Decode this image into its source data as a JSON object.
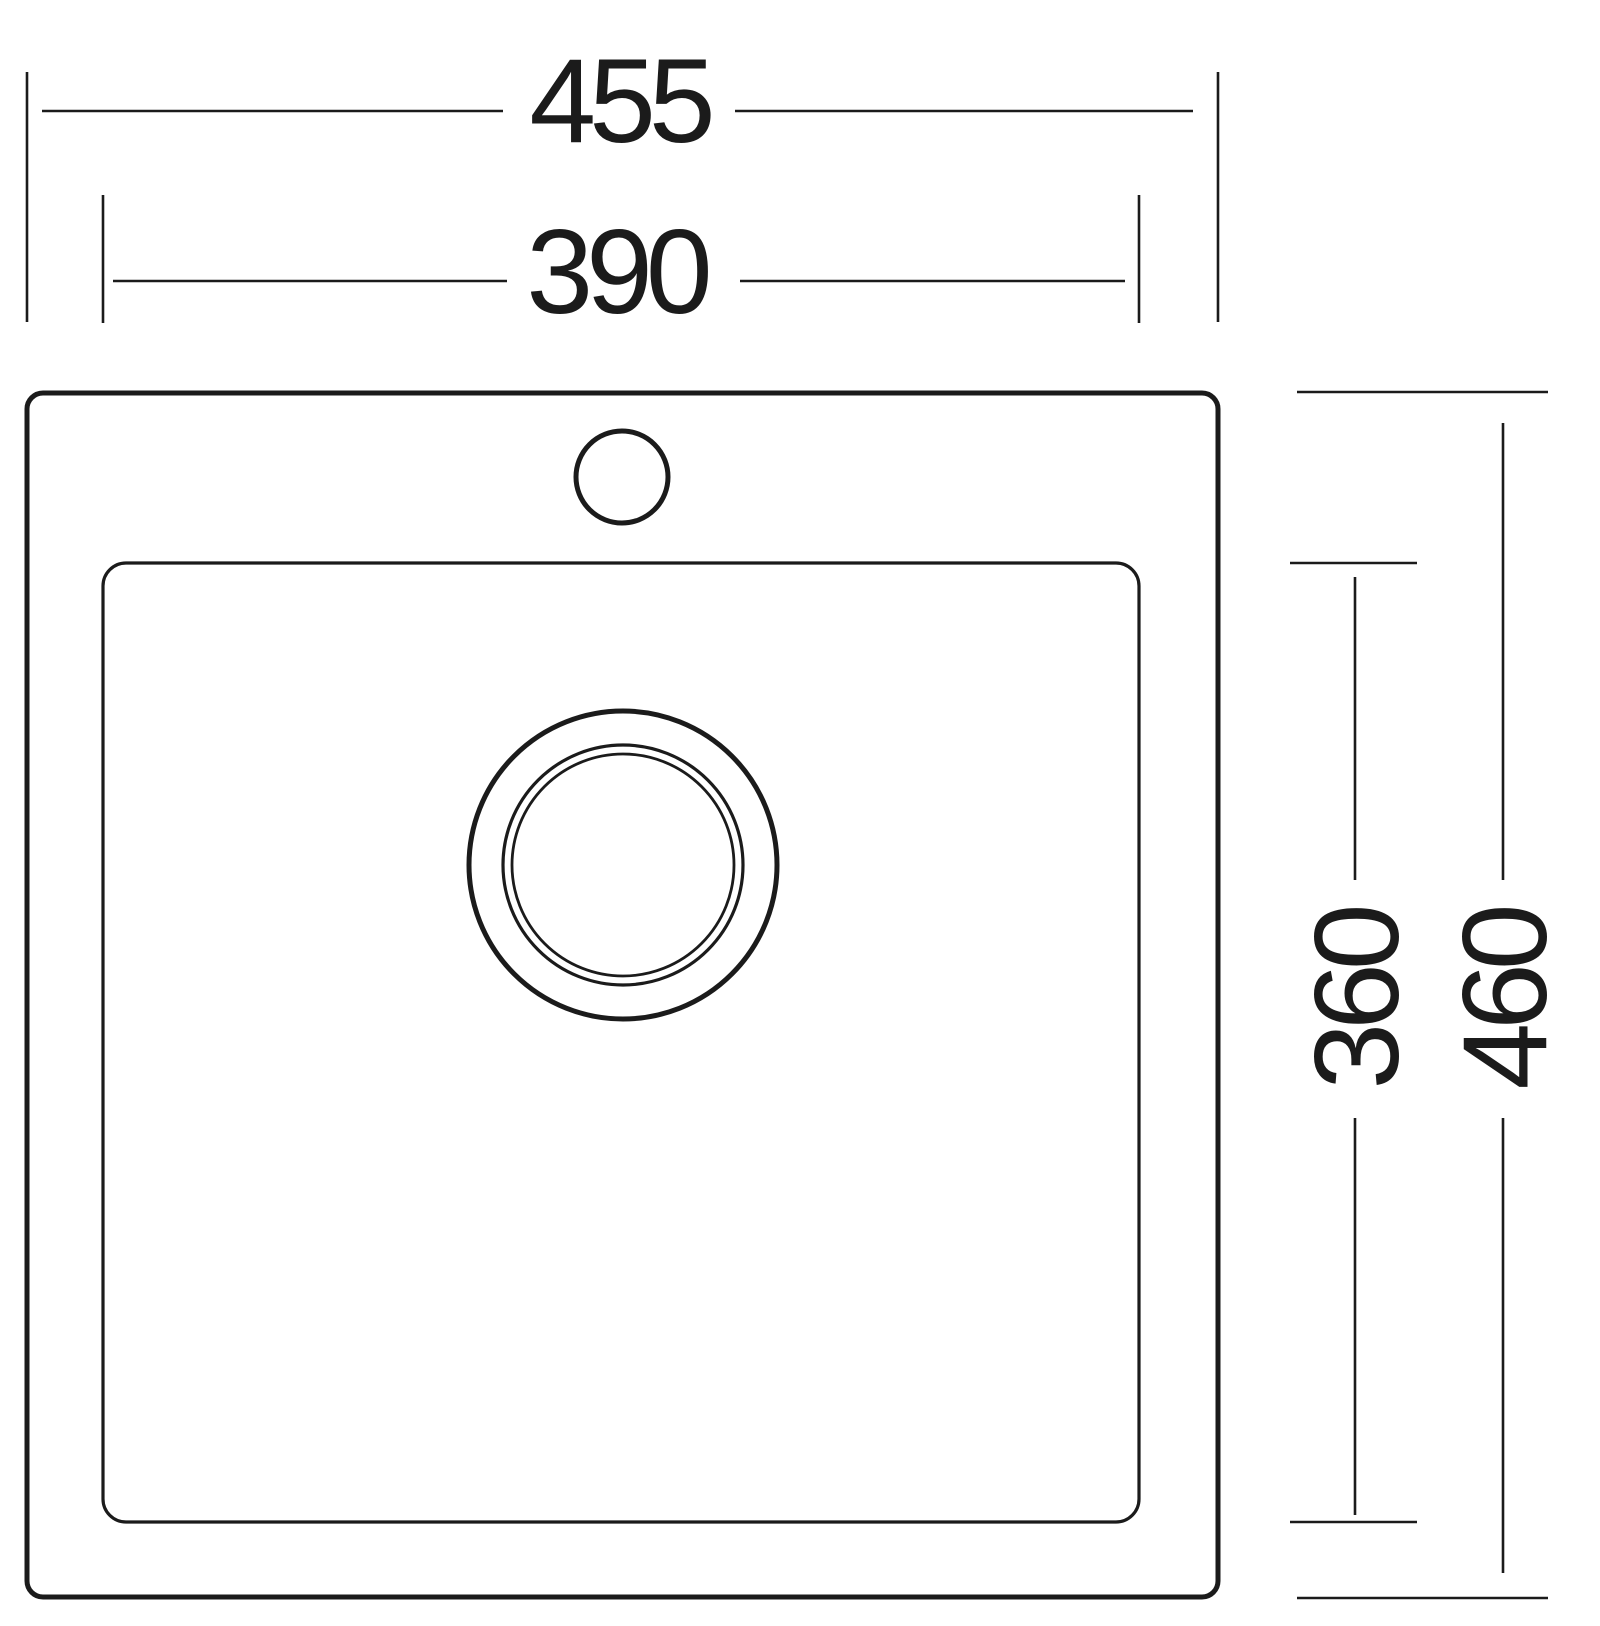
{
  "drawing": {
    "dimensions": {
      "overall_width": "455",
      "inner_width": "390",
      "inner_height": "360",
      "overall_height": "460"
    },
    "colors": {
      "line": "#1b1b1b",
      "background": "#ffffff"
    }
  }
}
